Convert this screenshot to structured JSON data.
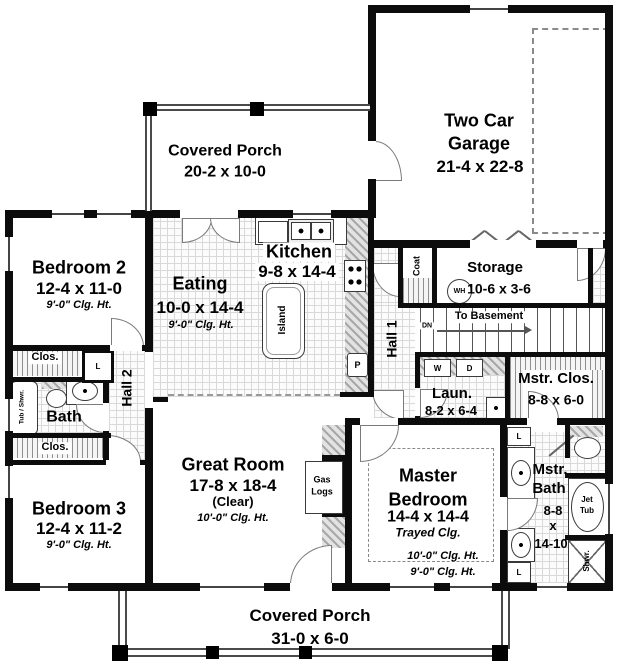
{
  "plan": {
    "porch_top": {
      "name": "Covered Porch",
      "dims": "20-2 x 10-0"
    },
    "garage": {
      "l1": "Two Car",
      "l2": "Garage",
      "dims": "21-4 x 22-8"
    },
    "bedroom2": {
      "name": "Bedroom 2",
      "dims": "12-4 x 11-0",
      "clg": "9'-0\" Clg. Ht."
    },
    "bedroom3": {
      "name": "Bedroom 3",
      "dims": "12-4 x 11-2",
      "clg": "9'-0\" Clg. Ht."
    },
    "eating": {
      "name": "Eating",
      "dims": "10-0 x 14-4",
      "clg": "9'-0\" Clg. Ht."
    },
    "kitchen": {
      "name": "Kitchen",
      "dims": "9-8 x 14-4",
      "island": "Island",
      "pantry": "P"
    },
    "coat": "Coat",
    "storage": {
      "name": "Storage",
      "dims": "10-6 x 3-6",
      "wh": "WH"
    },
    "stairs": {
      "label": "To Basement",
      "dn": "DN"
    },
    "hall1": "Hall 1",
    "hall2": "Hall 2",
    "closet": "Clos.",
    "linen": "L",
    "bath": {
      "name": "Bath",
      "tub": "Tub / Shwr."
    },
    "laundry": {
      "name": "Laun.",
      "dims": "8-2 x 6-4",
      "w": "W",
      "d": "D"
    },
    "mstr_clos": {
      "name": "Mstr. Clos.",
      "dims": "8-8 x 6-0"
    },
    "great_room": {
      "name": "Great Room",
      "dims": "17-8 x 18-4",
      "clear": "(Clear)",
      "clg": "10'-0\" Clg. Ht."
    },
    "fireplace": {
      "l1": "Gas",
      "l2": "Logs"
    },
    "master": {
      "l1": "Master",
      "l2": "Bedroom",
      "dims": "14-4 x 14-4",
      "tray": "Trayed Clg.",
      "clg1": "10'-0\" Clg. Ht.",
      "clg2": "9'-0\" Clg. Ht."
    },
    "mstr_bath": {
      "l1": "Mstr.",
      "l2": "Bath",
      "d1": "8-8",
      "d2": "x",
      "d3": "14-10",
      "jet1": "Jet",
      "jet2": "Tub",
      "shwr": "Shwr."
    },
    "porch_bottom": {
      "name": "Covered Porch",
      "dims": "31-0 x 6-0"
    }
  },
  "colors": {
    "wall": "#0c0c0c",
    "hatch_gray": "#a8a8a8",
    "dashed_gray": "#8a8a8a",
    "text": "#000000"
  }
}
